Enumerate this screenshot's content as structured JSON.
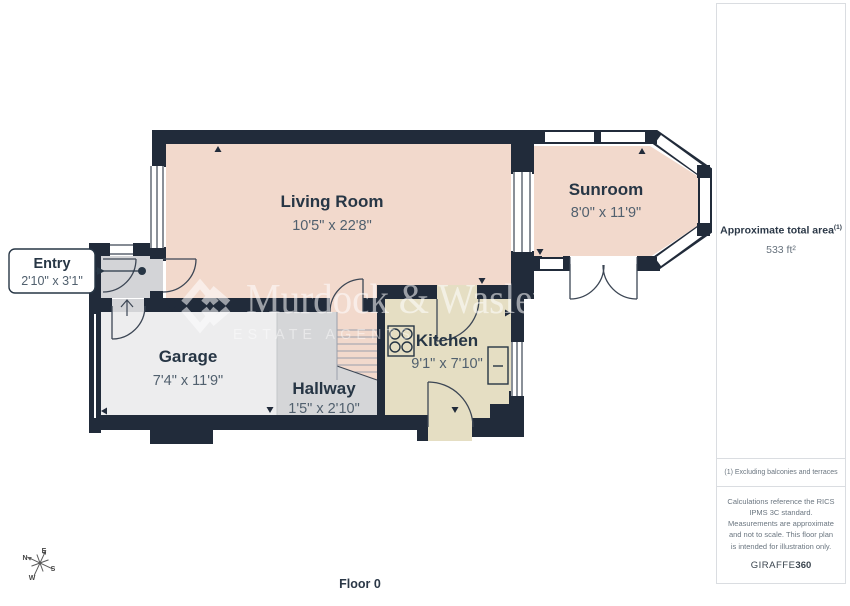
{
  "floorplan": {
    "rooms": {
      "living_room": {
        "name": "Living Room",
        "dims": "10'5\" x 22'8\""
      },
      "sunroom": {
        "name": "Sunroom",
        "dims": "8'0\" x 11'9\""
      },
      "entry": {
        "name": "Entry",
        "dims": "2'10\" x 3'1\""
      },
      "garage": {
        "name": "Garage",
        "dims": "7'4\" x 11'9\""
      },
      "hallway": {
        "name": "Hallway",
        "dims": "1'5\" x 2'10\""
      },
      "kitchen": {
        "name": "Kitchen",
        "dims": "9'1\" x 7'10\""
      }
    },
    "floor_label": "Floor 0",
    "compass": {
      "n": "N",
      "e": "E",
      "s": "S",
      "w": "W"
    }
  },
  "watermark": {
    "brand": "Murdock & Wasley",
    "tagline": "ESTATE AGENTS"
  },
  "sidebar": {
    "area_title": "Approximate total area",
    "area_superscript": "(1)",
    "area_value": "533 ft²",
    "footnote": "(1) Excluding balconies and terraces",
    "disclaimer": "Calculations reference the RICS IPMS 3C standard. Measurements are approximate and not to scale. This floor plan is intended for illustration only.",
    "brand_name": "GIRAFFE",
    "brand_number": "360"
  },
  "colors": {
    "wall": "#212b3a",
    "line": "#3c4654",
    "pink": "#f2d9cc",
    "beige": "#e5dec3",
    "hall": "#d5d6d8",
    "garage": "#ededee",
    "entry": "#d3d4d7",
    "textdark": "#273645",
    "textdim": "#51606e"
  }
}
